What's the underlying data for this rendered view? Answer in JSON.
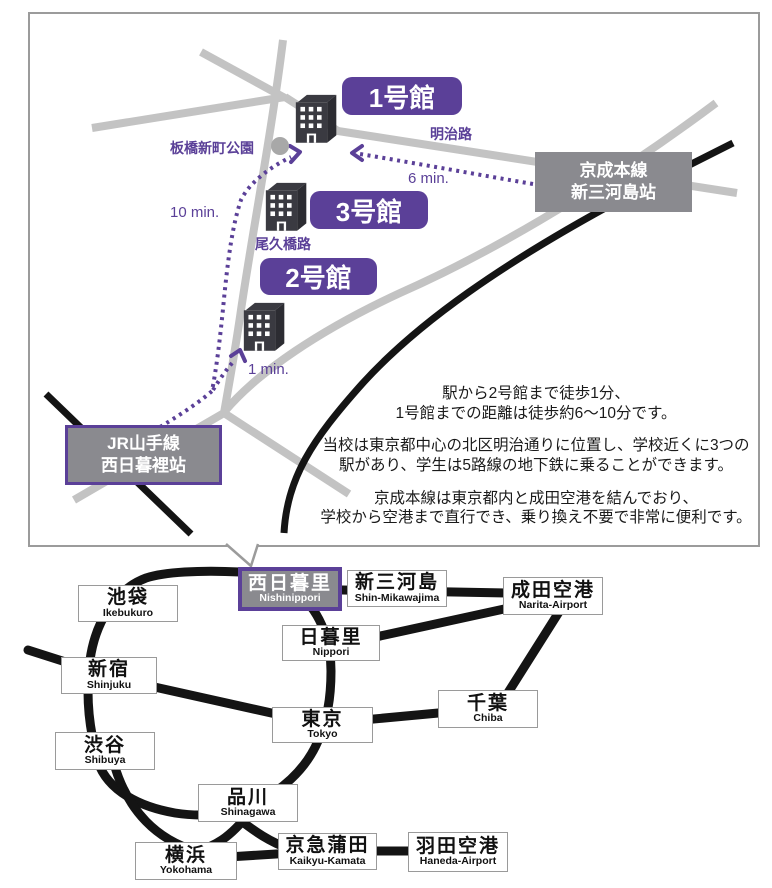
{
  "colors": {
    "accent_purple": "#5b4098",
    "road_gray": "#c3c3c3",
    "rail_black": "#141414",
    "station_box_gray": "#8a8a8f",
    "building_dark": "#3a3a41"
  },
  "campus_map": {
    "building_labels": [
      {
        "label": "1号館"
      },
      {
        "label": "3号館"
      },
      {
        "label": "2号館"
      }
    ],
    "road_labels": {
      "meiji": "明治路",
      "ogubashi": "尾久橋路"
    },
    "park_label": "板橋新町公園",
    "walk_times": {
      "six": "6 min.",
      "ten": "10 min.",
      "one": "1 min."
    },
    "stations": {
      "keisei": {
        "line": "京成本線",
        "station": "新三河島站"
      },
      "jr": {
        "line": "JR山手線",
        "station": "西日暮裡站"
      }
    },
    "description": {
      "p1l1": "駅から2号館まで徒歩1分、",
      "p1l2": "1号館までの距離は徒歩約6～10分です。",
      "p2l1": "当校は東京都中心の北区明治通りに位置し、学校近くに3つの",
      "p2l2": "駅があり、学生は5路線の地下鉄に乗ることができます。",
      "p3l1": "京成本線は東京都内と成田空港を結んでおり、",
      "p3l2": "学校から空港まで直行でき、乗り換え不要で非常に便利です。"
    }
  },
  "network": {
    "stations": [
      {
        "name": "池袋",
        "romaji": "Ikebukuro"
      },
      {
        "name": "西日暮里",
        "romaji": "Nishinippori"
      },
      {
        "name": "新三河島",
        "romaji": "Shin-Mikawajima"
      },
      {
        "name": "成田空港",
        "romaji": "Narita-Airport"
      },
      {
        "name": "日暮里",
        "romaji": "Nippori"
      },
      {
        "name": "新宿",
        "romaji": "Shinjuku"
      },
      {
        "name": "千葉",
        "romaji": "Chiba"
      },
      {
        "name": "東京",
        "romaji": "Tokyo"
      },
      {
        "name": "渋谷",
        "romaji": "Shibuya"
      },
      {
        "name": "品川",
        "romaji": "Shinagawa"
      },
      {
        "name": "横浜",
        "romaji": "Yokohama"
      },
      {
        "name": "京急蒲田",
        "romaji": "Kaikyu-Kamata"
      },
      {
        "name": "羽田空港",
        "romaji": "Haneda-Airport"
      }
    ]
  }
}
